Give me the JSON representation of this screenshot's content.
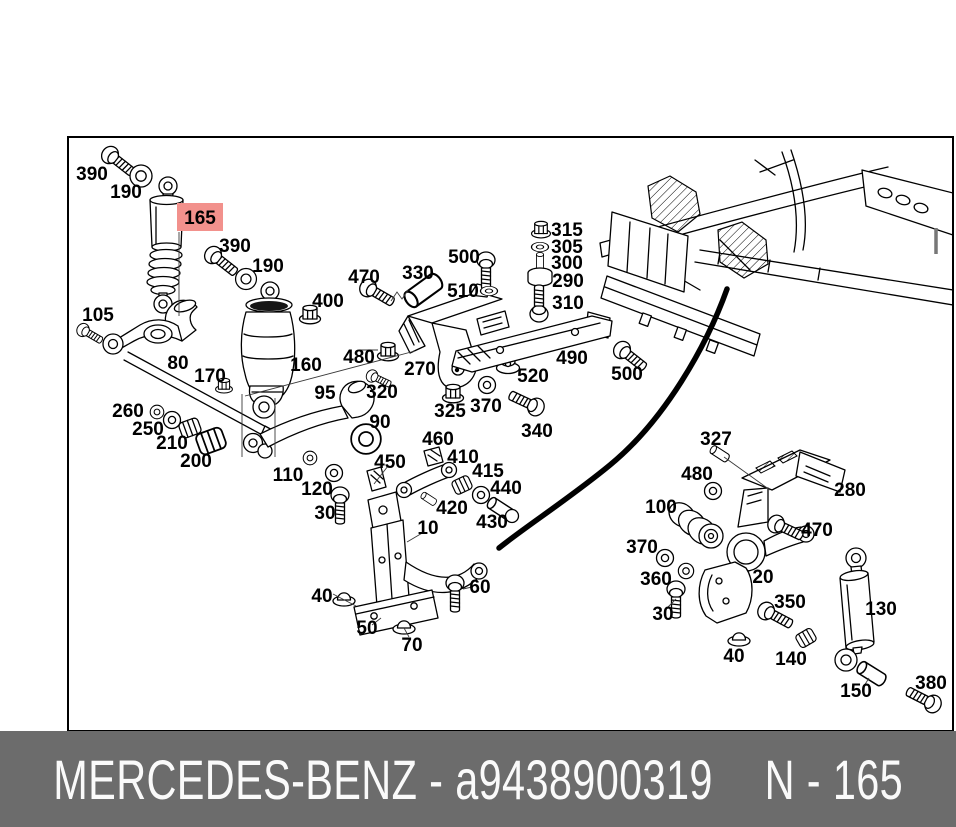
{
  "footer": {
    "left": "MERCEDES-BENZ - a9438900319",
    "right": "N - 165",
    "bg": "#6c6c6c",
    "fg": "#fafafa"
  },
  "highlight": {
    "bg": "#f2918c",
    "fg": "#9e1a12"
  },
  "diagram": {
    "description": "exploded-parts-diagram",
    "labels": [
      {
        "text": "390",
        "x": 92,
        "y": 173
      },
      {
        "text": "190",
        "x": 126,
        "y": 191
      },
      {
        "text": "165",
        "x": 200,
        "y": 217,
        "highlight": true,
        "w": 46,
        "h": 28
      },
      {
        "text": "390",
        "x": 235,
        "y": 245
      },
      {
        "text": "190",
        "x": 268,
        "y": 265
      },
      {
        "text": "400",
        "x": 328,
        "y": 300
      },
      {
        "text": "470",
        "x": 364,
        "y": 276
      },
      {
        "text": "330",
        "x": 418,
        "y": 272
      },
      {
        "text": "500",
        "x": 464,
        "y": 256
      },
      {
        "text": "510",
        "x": 463,
        "y": 290
      },
      {
        "text": "315",
        "x": 567,
        "y": 229
      },
      {
        "text": "305",
        "x": 567,
        "y": 246
      },
      {
        "text": "300",
        "x": 567,
        "y": 262
      },
      {
        "text": "290",
        "x": 568,
        "y": 280
      },
      {
        "text": "310",
        "x": 568,
        "y": 302
      },
      {
        "text": "105",
        "x": 98,
        "y": 314
      },
      {
        "text": "80",
        "x": 178,
        "y": 362
      },
      {
        "text": "170",
        "x": 210,
        "y": 375
      },
      {
        "text": "160",
        "x": 306,
        "y": 364
      },
      {
        "text": "480",
        "x": 359,
        "y": 356
      },
      {
        "text": "270",
        "x": 420,
        "y": 368
      },
      {
        "text": "320",
        "x": 382,
        "y": 391
      },
      {
        "text": "95",
        "x": 325,
        "y": 392
      },
      {
        "text": "325",
        "x": 450,
        "y": 410
      },
      {
        "text": "370",
        "x": 486,
        "y": 405
      },
      {
        "text": "520",
        "x": 533,
        "y": 375
      },
      {
        "text": "490",
        "x": 572,
        "y": 357
      },
      {
        "text": "500",
        "x": 627,
        "y": 373
      },
      {
        "text": "340",
        "x": 537,
        "y": 430
      },
      {
        "text": "260",
        "x": 128,
        "y": 410
      },
      {
        "text": "250",
        "x": 148,
        "y": 428
      },
      {
        "text": "210",
        "x": 172,
        "y": 442
      },
      {
        "text": "200",
        "x": 196,
        "y": 460
      },
      {
        "text": "90",
        "x": 380,
        "y": 421
      },
      {
        "text": "110",
        "x": 288,
        "y": 474
      },
      {
        "text": "120",
        "x": 317,
        "y": 488
      },
      {
        "text": "30",
        "x": 325,
        "y": 512
      },
      {
        "text": "450",
        "x": 390,
        "y": 461
      },
      {
        "text": "460",
        "x": 438,
        "y": 438
      },
      {
        "text": "410",
        "x": 463,
        "y": 456
      },
      {
        "text": "415",
        "x": 488,
        "y": 470
      },
      {
        "text": "440",
        "x": 506,
        "y": 487
      },
      {
        "text": "420",
        "x": 452,
        "y": 507
      },
      {
        "text": "430",
        "x": 492,
        "y": 521
      },
      {
        "text": "10",
        "x": 428,
        "y": 527
      },
      {
        "text": "40",
        "x": 322,
        "y": 595
      },
      {
        "text": "50",
        "x": 367,
        "y": 627
      },
      {
        "text": "60",
        "x": 480,
        "y": 586
      },
      {
        "text": "70",
        "x": 412,
        "y": 644
      },
      {
        "text": "327",
        "x": 716,
        "y": 438
      },
      {
        "text": "480",
        "x": 697,
        "y": 473
      },
      {
        "text": "280",
        "x": 850,
        "y": 489
      },
      {
        "text": "100",
        "x": 661,
        "y": 506
      },
      {
        "text": "470",
        "x": 817,
        "y": 529
      },
      {
        "text": "370",
        "x": 642,
        "y": 546
      },
      {
        "text": "360",
        "x": 656,
        "y": 578
      },
      {
        "text": "30",
        "x": 663,
        "y": 613
      },
      {
        "text": "20",
        "x": 763,
        "y": 576
      },
      {
        "text": "350",
        "x": 790,
        "y": 601
      },
      {
        "text": "130",
        "x": 881,
        "y": 608
      },
      {
        "text": "40",
        "x": 734,
        "y": 655
      },
      {
        "text": "140",
        "x": 791,
        "y": 658
      },
      {
        "text": "150",
        "x": 856,
        "y": 690
      },
      {
        "text": "380",
        "x": 931,
        "y": 682
      }
    ]
  }
}
